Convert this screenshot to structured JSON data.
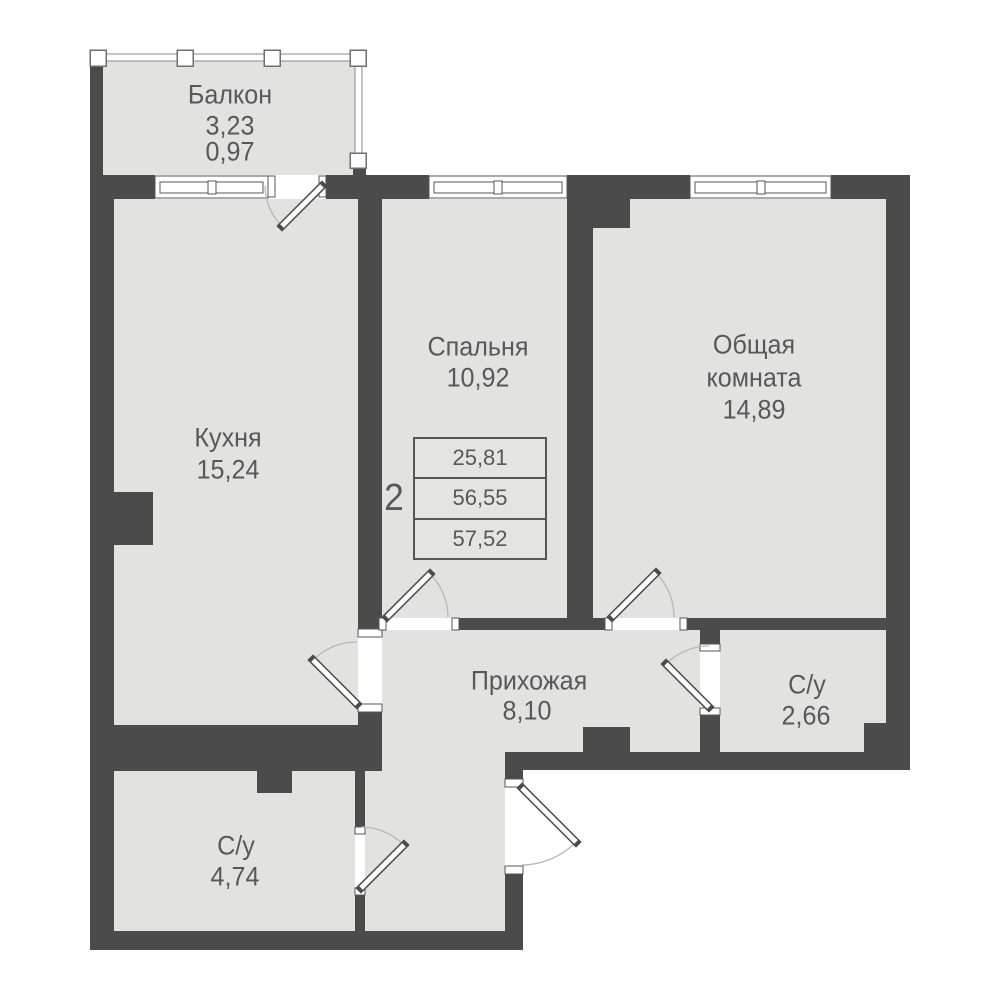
{
  "plan": {
    "kind": "apartment-floor-plan",
    "colors": {
      "wall": "#4b4b4b",
      "floor": "#e2e2e1",
      "outside": "#ffffff",
      "text": "#58585a",
      "door_arc": "#b8b8b8",
      "frame_stroke": "#57575a"
    },
    "rooms": {
      "balcony": {
        "name": "Балкон",
        "area": "3,23",
        "area_coeff": "0,97"
      },
      "kitchen": {
        "name": "Кухня",
        "area": "15,24"
      },
      "bedroom": {
        "name": "Спальня",
        "area": "10,92"
      },
      "living_room": {
        "name_line1": "Общая",
        "name_line2": "комната",
        "area": "14,89"
      },
      "hallway": {
        "name": "Прихожая",
        "area": "8,10"
      },
      "bathroom_small": {
        "name": "С/у",
        "area": "2,66"
      },
      "bathroom_large": {
        "name": "С/у",
        "area": "4,74"
      }
    },
    "legend": {
      "room_count": "2",
      "rows": [
        "25,81",
        "56,55",
        "57,52"
      ]
    }
  }
}
